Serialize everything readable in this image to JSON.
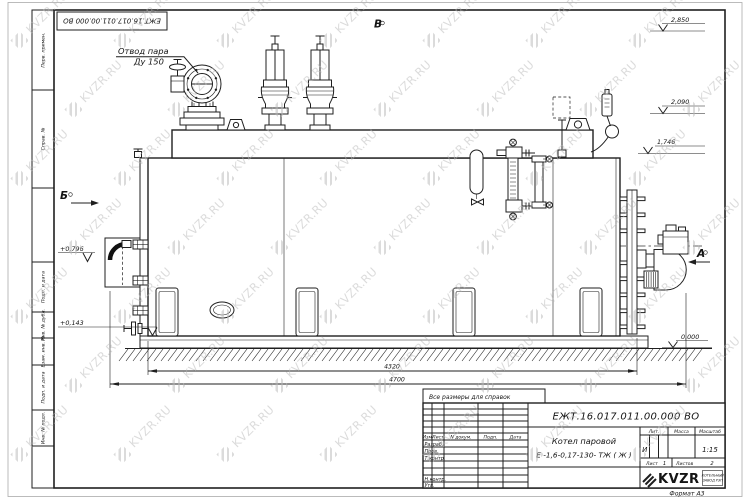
{
  "watermark": {
    "text": "KVZR.RU"
  },
  "sheet": {
    "stamp_code": "ЕЖТ.16.017.011.00.000  ВО",
    "note": "Все размеры для справок",
    "format_label": "Формат А3"
  },
  "border_column": {
    "items": [
      "Перв. примен.",
      "Справ. №",
      "Подп. и дата",
      "Инв. № дубл.",
      "Взам. инв. №",
      "Подп. и дата",
      "Инв. № подл."
    ]
  },
  "views": {
    "a": "А",
    "b": "Б",
    "v": "В"
  },
  "elevations": {
    "e2850": "2,850",
    "e2090": "2,090",
    "e1746": "1,746",
    "e0000": "0,000",
    "e0796": "+0,796",
    "e0143": "+0,143"
  },
  "dimensions": {
    "d4320": "4320",
    "d4700": "4700"
  },
  "callouts": {
    "steam_line1": "Отвод пара",
    "steam_line2": "Ду 150"
  },
  "title_block": {
    "code": "ЕЖТ.16.017.011.00.000  ВО",
    "product_line1": "Котел паровой",
    "product_line2": "Е -1,6-0,17-130- ТЖ ( Ж )",
    "col_izm": "Изм",
    "col_list": "Лист",
    "col_ndoc": "N докум.",
    "col_podp": "Подп.",
    "col_data": "Дата",
    "row_razrab": "Разраб.",
    "row_prov": "Пров.",
    "row_tkontr": "Т.контр.",
    "row_nkontr": "Н.контр.",
    "row_utv": "Утв.",
    "lit_label": "Лит.",
    "lit_value": "И",
    "massa_label": "Масса",
    "masshtab_label": "Масштаб",
    "scale": "1:15",
    "sheet_label": "Лист",
    "sheet_value": "1",
    "sheets_label": "Листов",
    "sheets_value": "2",
    "logo_text": "KVZR",
    "logo_sub1": "КОТЕЛЬНЫЙ",
    "logo_sub2": "ЗАВОД РЭП"
  }
}
